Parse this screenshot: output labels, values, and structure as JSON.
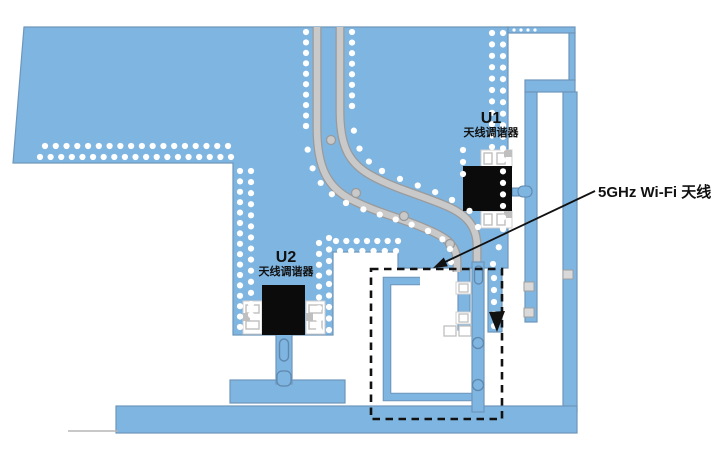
{
  "title": "PCB antenna layout with antenna tuners",
  "labels": {
    "u1_ref": "U1",
    "u1_desc": "天线调谐器",
    "u2_ref": "U2",
    "u2_desc": "天线调谐器",
    "antenna": "5GHz Wi-Fi 天线"
  },
  "colors": {
    "copper": "#7FB5E1",
    "copper_outline": "#6E96BA",
    "copper_inner": "#5F88AD",
    "trace_fill": "#C9C9C9",
    "trace_outline": "#9A9A9A",
    "component_black": "#0B0B0B",
    "pad_white": "#FFFFFF",
    "pad_gray": "#BFBFBF",
    "via_white": "#FFFFFF",
    "annotation_black": "#111111",
    "board_edge_gray": "#B5B5B5"
  }
}
